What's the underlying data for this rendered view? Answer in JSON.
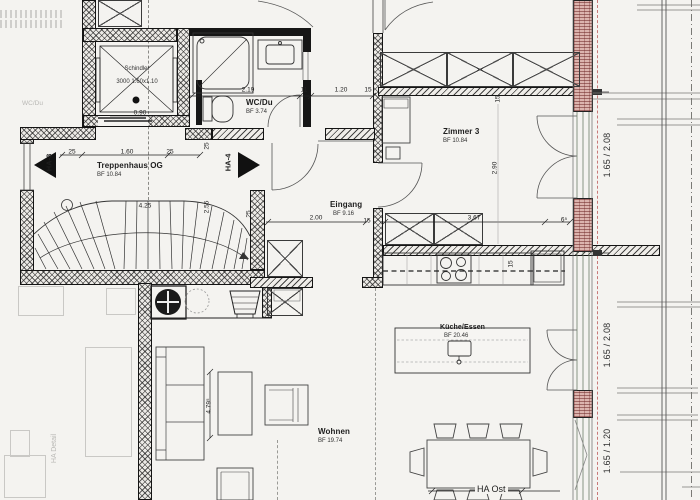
{
  "meta": {
    "drawing_type": "architectural floor plan (scan)",
    "floor": "OG"
  },
  "rooms": {
    "treppenhaus": {
      "name": "Treppenhaus OG",
      "area": "BF 10.84"
    },
    "wc": {
      "name": "WC/Du",
      "area": "BF 3.74"
    },
    "eingang": {
      "name": "Eingang",
      "area": "BF 9.16"
    },
    "zimmer3": {
      "name": "Zimmer 3",
      "area": "BF 10.84"
    },
    "kueche": {
      "name": "Küche/Essen",
      "area": "BF 20.46"
    },
    "wohnen": {
      "name": "Wohnen",
      "area": "BF 19.74"
    }
  },
  "elevator": {
    "line1": "Schindler",
    "line2": "3000 1.60x1.10"
  },
  "markers": {
    "ha3": "HA-3",
    "ha4": "HA-4",
    "ha_ost": "HA Ost"
  },
  "ghost": {
    "ha_detail": "HA Detail",
    "wc_du": "WC/Du"
  },
  "colors": {
    "paper": "#f4f3f0",
    "ink": "#1d1d1d",
    "wall_fill": "#eceae6",
    "brick_wall": "#dcb4ae",
    "red_dashed": "#c87878"
  },
  "dimensions": [
    {
      "t": "25",
      "x": 72,
      "y": 152
    },
    {
      "t": "1.60",
      "x": 127,
      "y": 152
    },
    {
      "t": "25",
      "x": 170,
      "y": 152
    },
    {
      "t": "0.90",
      "x": 140,
      "y": 113
    },
    {
      "t": "2.19",
      "x": 248,
      "y": 90
    },
    {
      "t": "11",
      "x": 304,
      "y": 90
    },
    {
      "t": "1.20",
      "x": 341,
      "y": 90
    },
    {
      "t": "15",
      "x": 368,
      "y": 90
    },
    {
      "t": "25",
      "x": 207,
      "y": 146,
      "r": -90
    },
    {
      "t": "2.55",
      "x": 207,
      "y": 207,
      "r": -90
    },
    {
      "t": "25",
      "x": 249,
      "y": 214,
      "r": -90
    },
    {
      "t": "4.25",
      "x": 145,
      "y": 206
    },
    {
      "t": "2.00",
      "x": 316,
      "y": 218
    },
    {
      "t": "15",
      "x": 367,
      "y": 221
    },
    {
      "t": "3.67",
      "x": 474,
      "y": 218
    },
    {
      "t": "6⁵",
      "x": 564,
      "y": 220
    },
    {
      "t": "15",
      "x": 498,
      "y": 99,
      "r": -90
    },
    {
      "t": "2.90",
      "x": 495,
      "y": 168,
      "r": -90
    },
    {
      "t": "15",
      "x": 511,
      "y": 264,
      "r": -90
    },
    {
      "t": "4.79⁵",
      "x": 209,
      "y": 406,
      "r": -90
    },
    {
      "t": "1.65 / 2.08",
      "x": 607,
      "y": 155,
      "r": -90,
      "c": "win"
    },
    {
      "t": "1.65 / 2.08",
      "x": 607,
      "y": 345,
      "r": -90,
      "c": "win"
    },
    {
      "t": "1.65 / 1.20",
      "x": 607,
      "y": 451,
      "r": -90,
      "c": "win"
    }
  ]
}
